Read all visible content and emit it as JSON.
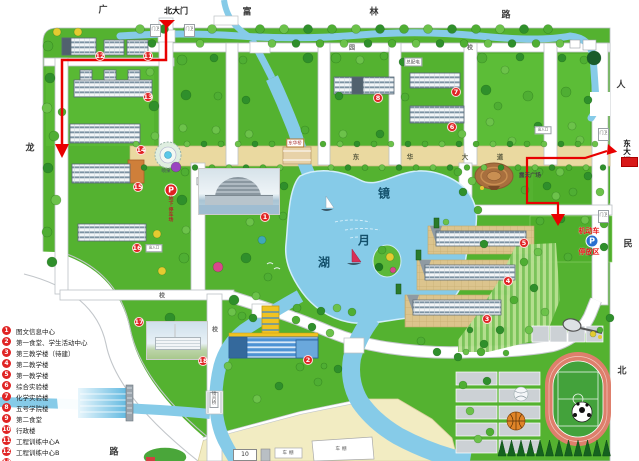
{
  "map": {
    "gates": {
      "north": "北大门",
      "east": "东大门",
      "guard": "门卫"
    },
    "roads": {
      "top_partial": "广",
      "fulin": [
        "富",
        "林",
        "路"
      ],
      "renmin": [
        "人",
        "民",
        "北"
      ],
      "left": [
        "龙",
        "路"
      ],
      "avenue": [
        "东",
        "华",
        "大",
        "道"
      ],
      "campus_chars": [
        "园",
        "校",
        "校",
        "校"
      ]
    },
    "lake": {
      "name": [
        "镜",
        "月",
        "湖"
      ]
    },
    "bridges": {
      "east_bridge": "东华桥",
      "south_bridge": "镜月桥"
    },
    "labels": {
      "plaza": "露天广场",
      "fountain": "喷泉",
      "power": "总配电",
      "p": "P",
      "underground_parking": "地下停车场",
      "vehicle_area_line1": "机动车",
      "vehicle_area_line2": "停放区",
      "no_motor_zone": "机动车禁行区",
      "shed": "车棚",
      "building10": "10",
      "entrance": "出入口"
    },
    "badges": [
      {
        "n": "1",
        "x": 265,
        "y": 217
      },
      {
        "n": "2",
        "x": 308,
        "y": 360
      },
      {
        "n": "3",
        "x": 487,
        "y": 319
      },
      {
        "n": "4",
        "x": 508,
        "y": 281
      },
      {
        "n": "5",
        "x": 524,
        "y": 243
      },
      {
        "n": "6",
        "x": 452,
        "y": 127
      },
      {
        "n": "7",
        "x": 456,
        "y": 92
      },
      {
        "n": "8",
        "x": 378,
        "y": 98
      },
      {
        "n": "11",
        "x": 148,
        "y": 56
      },
      {
        "n": "12",
        "x": 100,
        "y": 56
      },
      {
        "n": "13",
        "x": 148,
        "y": 97
      },
      {
        "n": "14",
        "x": 141,
        "y": 150
      },
      {
        "n": "15",
        "x": 138,
        "y": 187
      },
      {
        "n": "16",
        "x": 137,
        "y": 248
      },
      {
        "n": "17",
        "x": 139,
        "y": 322
      },
      {
        "n": "18",
        "x": 203,
        "y": 361
      }
    ],
    "colors": {
      "lawn": "#54b230",
      "water": "#86cbe8",
      "route": "#e80000",
      "badge": "#e02424",
      "avenue": "#ead9a0",
      "track": "#de7f6c"
    }
  },
  "legend": {
    "items": [
      {
        "n": "1",
        "label": "图文信息中心"
      },
      {
        "n": "2",
        "label": "第一食堂、学生活动中心"
      },
      {
        "n": "3",
        "label": "第三教学楼（待建）"
      },
      {
        "n": "4",
        "label": "第二教学楼"
      },
      {
        "n": "5",
        "label": "第一教学楼"
      },
      {
        "n": "6",
        "label": "综合实验楼"
      },
      {
        "n": "7",
        "label": "化学实验楼"
      },
      {
        "n": "8",
        "label": "五号学院楼"
      },
      {
        "n": "9",
        "label": "第二食堂"
      },
      {
        "n": "10",
        "label": "行政楼"
      },
      {
        "n": "11",
        "label": "工程训练中心A"
      },
      {
        "n": "12",
        "label": "工程训练中心B"
      },
      {
        "n": "13",
        "label": ""
      }
    ]
  }
}
